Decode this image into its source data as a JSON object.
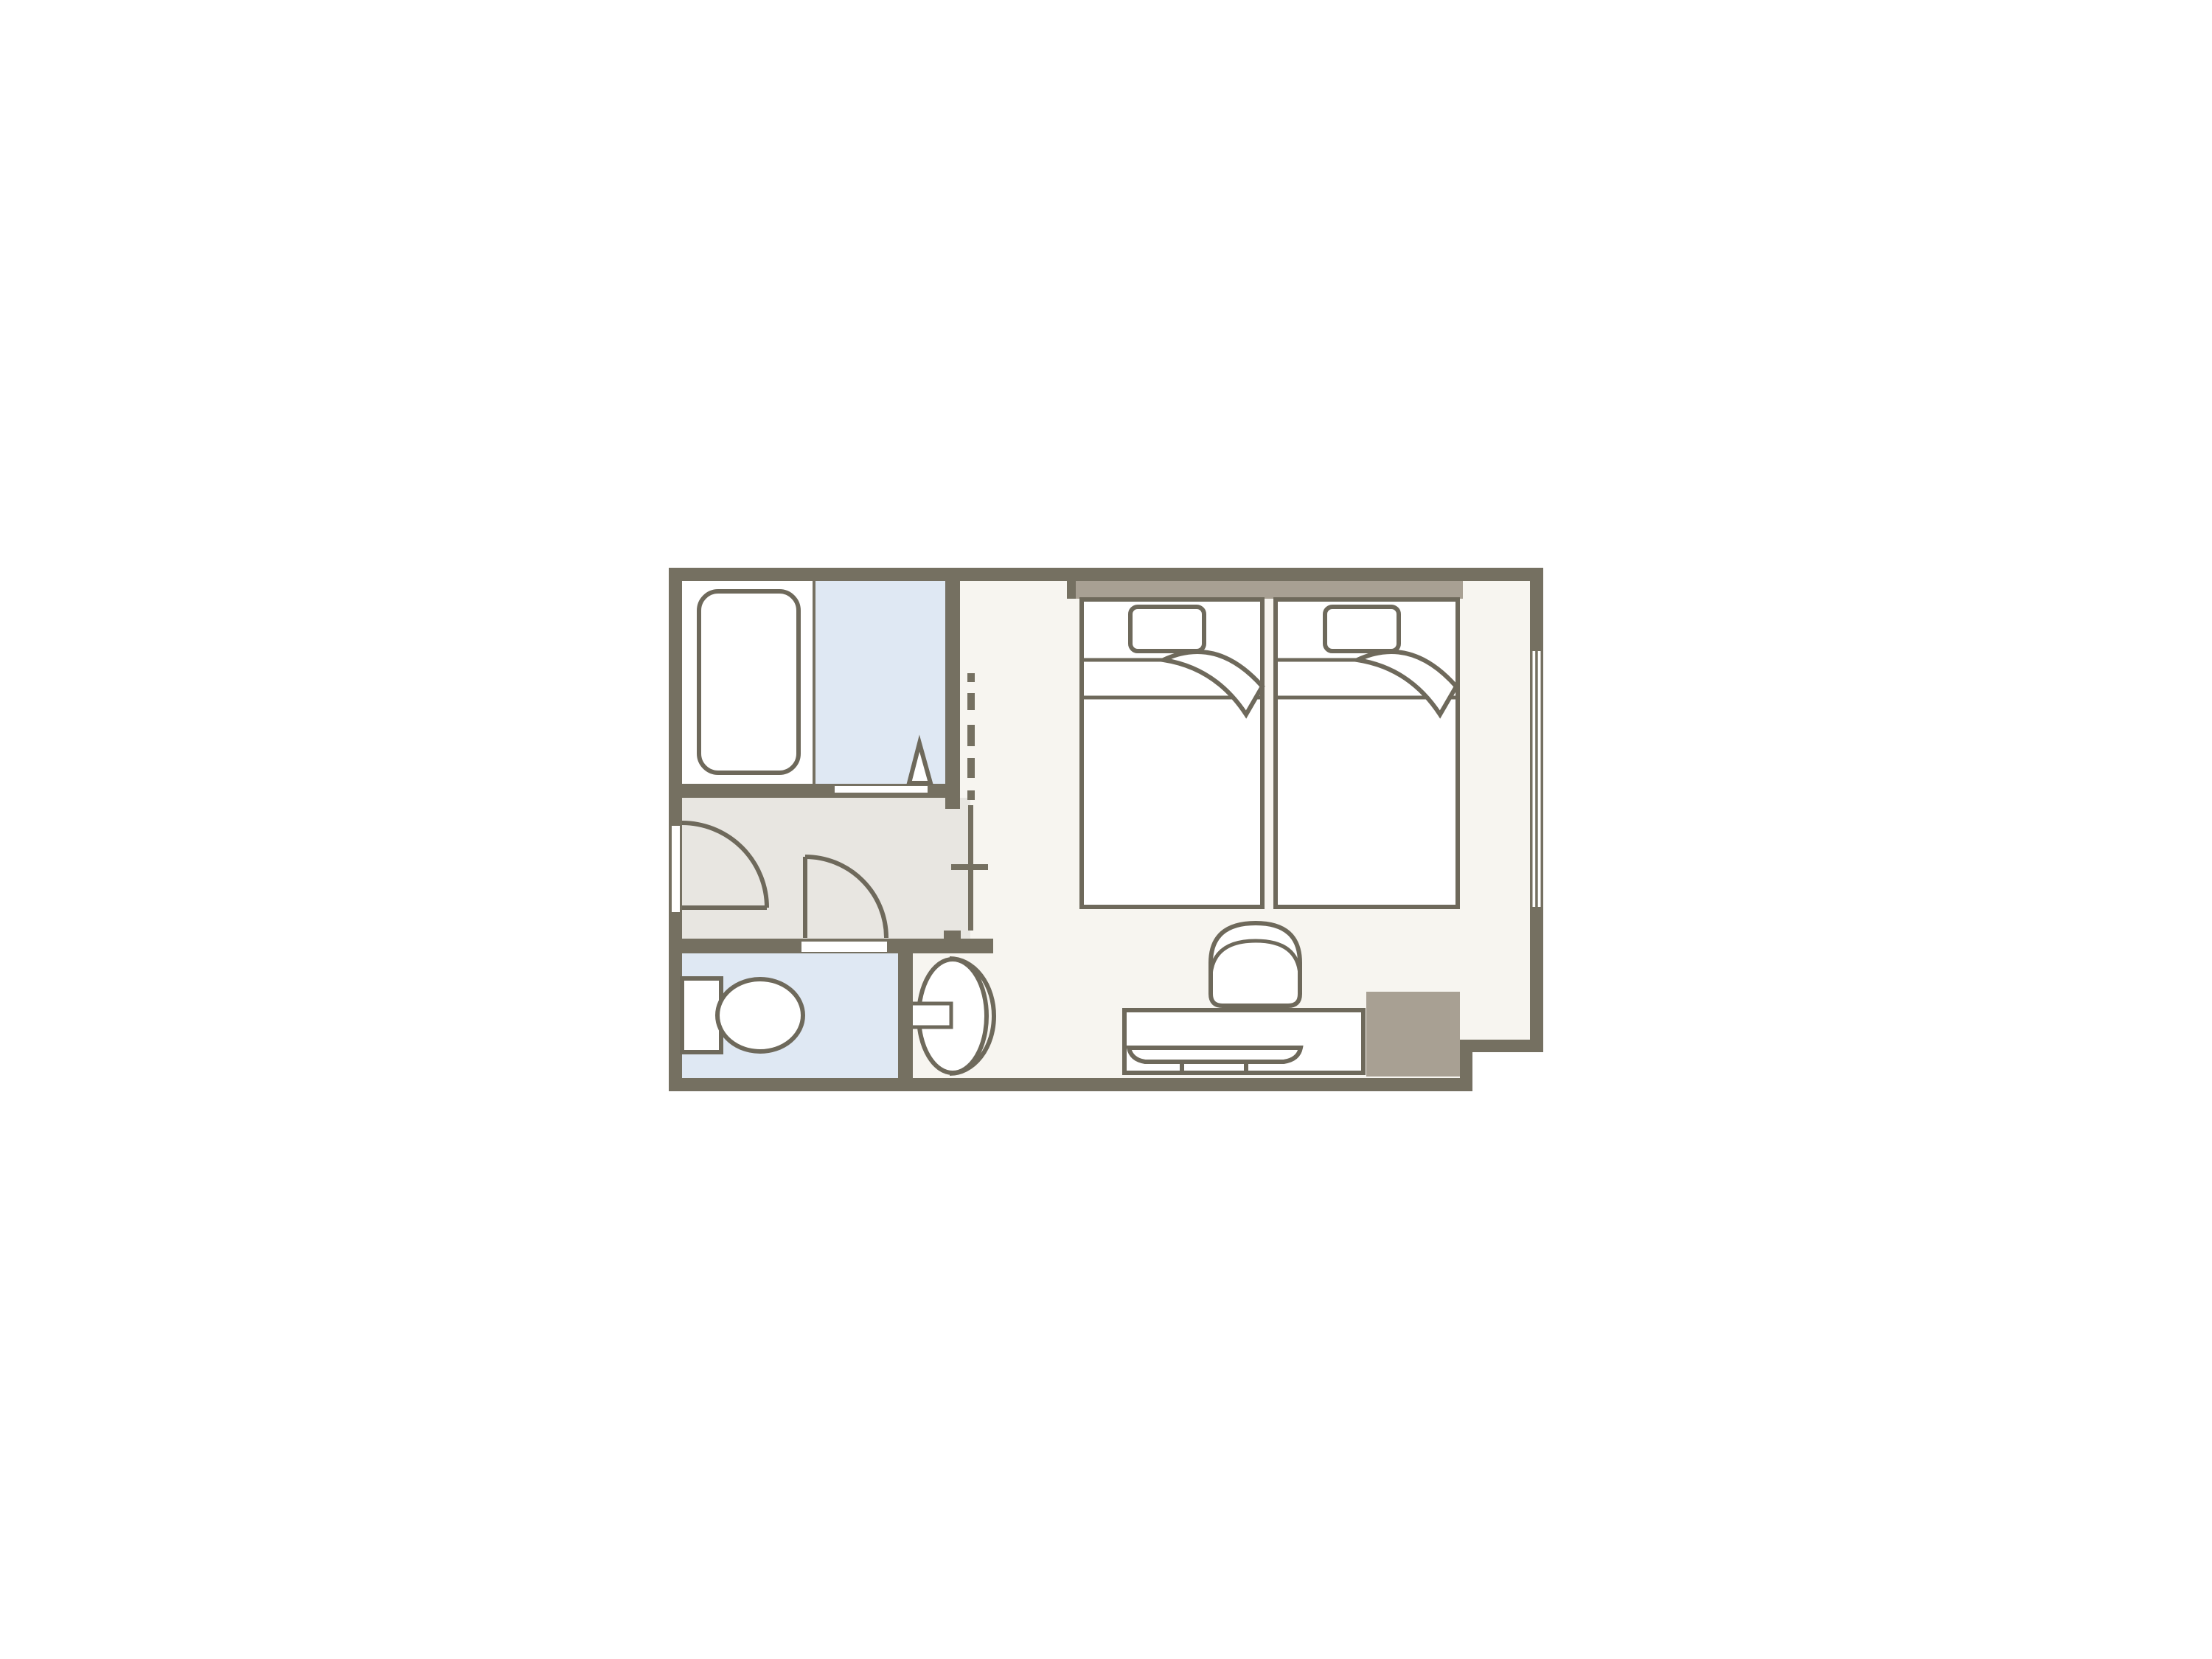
{
  "page": {
    "background": "#ffffff",
    "description": "hotel twin room floor plan"
  },
  "palette": {
    "page_bg": "#ffffff",
    "wall": "#757061",
    "accent": "#a8a093",
    "floor_main": "#f7f5f0",
    "floor_hall": "#e8e6e1",
    "floor_wet": "#dfe8f3",
    "fixture_stroke": "#6e695b",
    "white": "#ffffff"
  },
  "inventory": {
    "rooms": [
      "bathroom",
      "shower-area",
      "hallway",
      "toilet-room",
      "bedroom",
      "washbasin-alcove"
    ],
    "fixtures": [
      "bathtub",
      "folding-door",
      "entry-door",
      "toilet-door",
      "toilet",
      "washbasin",
      "twin-bed-left",
      "twin-bed-right",
      "pillow",
      "blanket-fold",
      "headboard",
      "chair",
      "desk",
      "tv",
      "cabinet",
      "window",
      "area-boundary-dashed-line"
    ]
  }
}
